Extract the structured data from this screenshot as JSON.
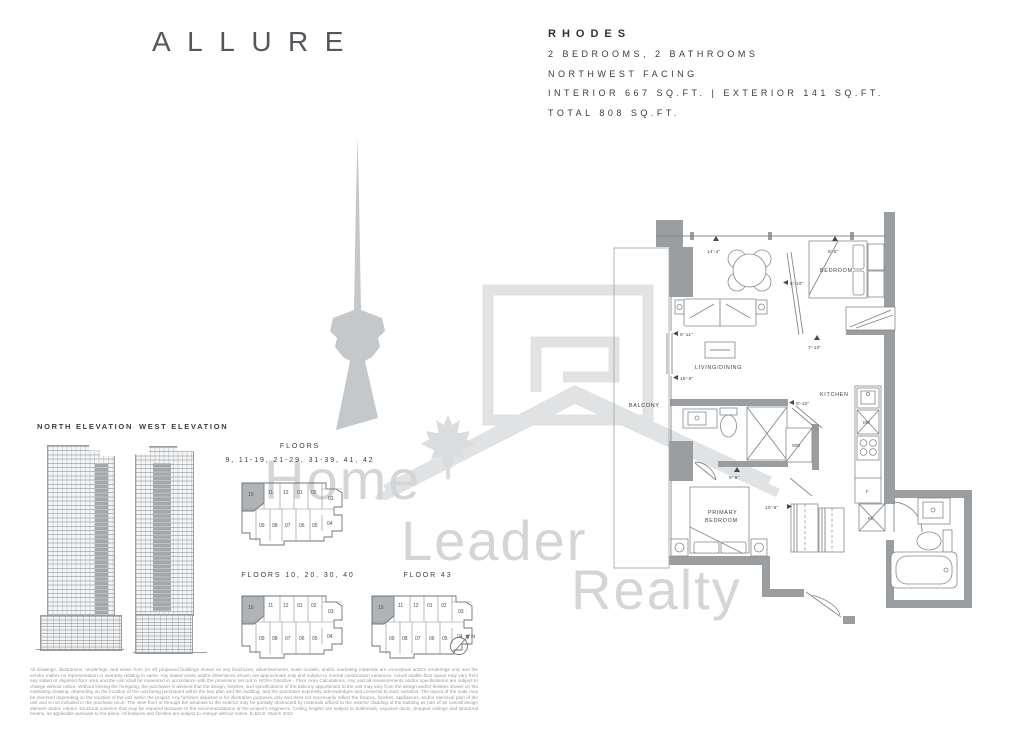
{
  "logo": {
    "text": "ALLURE"
  },
  "unit_info": {
    "name": "RHODES",
    "specs": [
      "2 BEDROOMS, 2 BATHROOMS",
      "NORTHWEST FACING",
      "INTERIOR 667 SQ.FT. | EXTERIOR 141 SQ.FT.",
      "TOTAL 808 SQ.FT."
    ]
  },
  "elevations": {
    "north": "NORTH ELEVATION",
    "west": "WEST ELEVATION"
  },
  "keyplans": [
    {
      "title_top": "FLOORS",
      "title_bottom": "9, 11-19, 21-29, 31-39, 41, 42",
      "highlighted": "10",
      "units": [
        "10",
        "11",
        "12",
        "01",
        "02",
        "03",
        "09",
        "08",
        "07",
        "06",
        "05",
        "04"
      ]
    },
    {
      "title": "FLOORS 10, 20, 30, 40",
      "highlighted": "10",
      "units": [
        "10",
        "11",
        "12",
        "01",
        "02",
        "03",
        "09",
        "08",
        "07",
        "06",
        "05",
        "04"
      ]
    },
    {
      "title": "FLOOR 43",
      "highlighted": "10",
      "units": [
        "10",
        "11",
        "12",
        "01",
        "02",
        "03",
        "09",
        "08",
        "07",
        "06",
        "05",
        "04"
      ]
    }
  ],
  "compass": {
    "label": "N"
  },
  "floorplan": {
    "rooms": {
      "balcony": "BALCONY",
      "living_dining": "LIVING/DINING",
      "bedroom": "BEDROOM",
      "kitchen": "KITCHEN",
      "primary_line1": "PRIMARY",
      "primary_line2": "BEDROOM"
    },
    "appliances": {
      "washer_dryer": "W/D",
      "dishwasher": "DW",
      "fridge": "F",
      "fan_coil": "FC"
    },
    "dimensions": {
      "living_width": "14'-4\"",
      "bedroom_width": "8'-5\"",
      "bedroom_depth": "8'-10\"",
      "living_depth": "9'-11\"",
      "living_length": "18'-5\"",
      "foyer_width": "7'-10\"",
      "ensuite_width": "8'-10\"",
      "ensuite_length": "8'-6\"",
      "primary_width": "10'-8\""
    }
  },
  "watermark": {
    "line1": "Home",
    "line2": "Leader",
    "line3": "Realty"
  },
  "colors": {
    "wall_gray": "#9b9ea1",
    "keyplan_highlight": "#b1b4b6",
    "cn_tower_gray": "#c5c8ca",
    "watermark_gray": "#d3d5d7"
  },
  "disclaimer": "All drawings, illustrations, renderings, and views from (or of) proposed buildings shown on any brochures, advertisements, scale models, and/or marketing materials are conceptual artist's renderings only and the vendor makes no representation or warranty relating to same. Any stated areas and/or dimensions shown are approximate only and subject to normal construction variances. Actual usable floor space may vary from any stated or depicted floor area and the unit shall be measured in accordance with the provisions set out in HCRA Directive - Floor Area Calculations. Any and all measurements and/or specifications are subject to change without notice. Without limiting the foregoing, the purchaser is advised that the design, finishes, and specifications of the balcony appurtenant to the unit may vary from the design and/or finishes shown on the marketing drawing, depending on the location of the unit being purchased within the key plan and the building, and the purchaser expressly acknowledges and consents to such variation. The layout of the suite may be reversed depending on the location of the unit within the project. Any furniture depicted is for illustration purposes only and does not necessarily reflect the fixtures, finishes, appliances, and/or electrical plan of the unit and is not included in the purchase price. The view from or through the windows to the exterior may be partially obstructed by materials affixed to the exterior cladding of the building as part of an overall design element and/or interior structural columns that may be required pursuant to the recommendations of the project's engineers. Ceiling heights are subject to bulkheads, exposed ducts, dropped ceilings and structural beams, as applicable pursuant to the plans. All features and finishes are subject to change without notice. E.&O.E. March 2022"
}
